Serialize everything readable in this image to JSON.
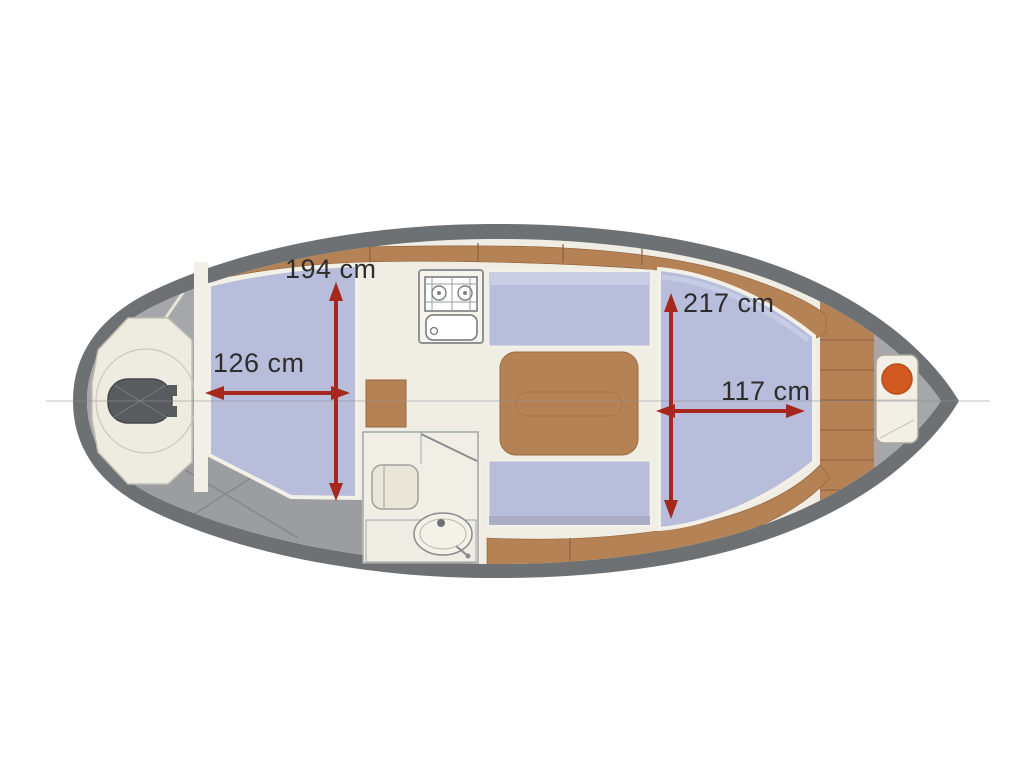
{
  "diagram": {
    "type": "boat-floor-plan-top-view",
    "dimensions": {
      "cockpit_beam": "194 cm",
      "cockpit_length": "126 cm",
      "bow_cabin_beam": "217 cm",
      "bow_cabin_length": "117 cm"
    },
    "colors": {
      "hull_outline": "#6e7174",
      "deck_gray": "#a2a4a7",
      "interior_cream": "#f0ede4",
      "cushion_blue": "#b7bddb",
      "cushion_blue_light": "#c9cee5",
      "wood_brown": "#b58255",
      "arrow_red": "#a6281c",
      "label_text": "#2e2c2c",
      "bow_fitting_orange": "#d2591f"
    }
  }
}
